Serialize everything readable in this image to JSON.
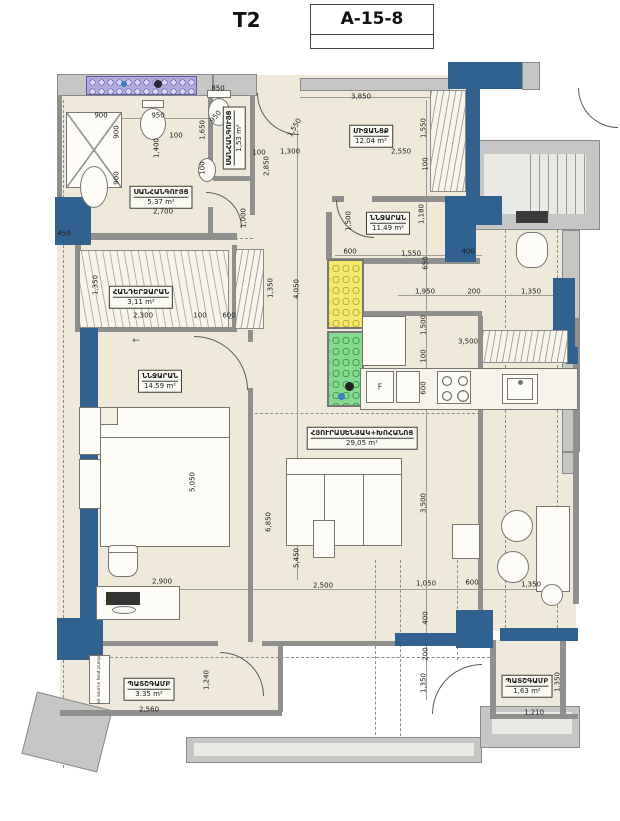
{
  "header": {
    "title": "T2",
    "code": "A-15-8"
  },
  "rooms": [
    {
      "name": "ՍԱՆՀԱՆԳՈՒՅՑ",
      "area": "5.37 m²"
    },
    {
      "name": "ՍԱՆՀԱՆԳՈՒՅՑ",
      "area": "1,53 m²"
    },
    {
      "name": "ՄԻՋԱՆՑՔ",
      "area": "12.04 m²"
    },
    {
      "name": "ՆՆՋԱՐԱՆ",
      "area": "11.49 m²"
    },
    {
      "name": "ՀԱՆԴԵՐՁԱՐԱՆ",
      "area": "3,11 m²"
    },
    {
      "name": "ՆՆՋԱՐԱՆ",
      "area": "14.59 m²"
    },
    {
      "name": "ՀՅՈՒՐԱՍԵՆՅԱԿ+ԽՈՀԱՆՈՑ",
      "area": "29,05 m²"
    },
    {
      "name": "ՊԱՏՇԳԱՄԲ",
      "area": "3.35 m²"
    },
    {
      "name": "ՊԱՏՇԳԱՄԲ",
      "area": "1,63 m²"
    }
  ],
  "annotations": {
    "heat_pump": "air source heat pump",
    "fridge_label": "F",
    "door_arrow": "←"
  },
  "dimensions": [
    {
      "t": "850",
      "x": 218,
      "y": 89
    },
    {
      "t": "900",
      "x": 101,
      "y": 116
    },
    {
      "t": "950",
      "x": 158,
      "y": 116
    },
    {
      "t": "950",
      "x": 216,
      "y": 117,
      "r": -50
    },
    {
      "t": "1,650",
      "x": 203,
      "y": 130,
      "r": -90
    },
    {
      "t": "100",
      "x": 176,
      "y": 136
    },
    {
      "t": "1,400",
      "x": 157,
      "y": 148,
      "r": -90
    },
    {
      "t": "900",
      "x": 117,
      "y": 132,
      "r": -90
    },
    {
      "t": "900",
      "x": 117,
      "y": 178,
      "r": -90
    },
    {
      "t": "100",
      "x": 203,
      "y": 168,
      "r": -90
    },
    {
      "t": "450",
      "x": 64,
      "y": 234
    },
    {
      "t": "1,000",
      "x": 244,
      "y": 218,
      "r": -90
    },
    {
      "t": "2,700",
      "x": 163,
      "y": 212
    },
    {
      "t": "3,850",
      "x": 361,
      "y": 97
    },
    {
      "t": "1,550",
      "x": 295,
      "y": 128,
      "r": -60
    },
    {
      "t": "1,550",
      "x": 424,
      "y": 128,
      "r": -90
    },
    {
      "t": "100",
      "x": 259,
      "y": 153
    },
    {
      "t": "1,300",
      "x": 290,
      "y": 152
    },
    {
      "t": "2,850",
      "x": 267,
      "y": 166,
      "r": -90
    },
    {
      "t": "2,550",
      "x": 401,
      "y": 152
    },
    {
      "t": "100",
      "x": 426,
      "y": 164,
      "r": -90
    },
    {
      "t": "1,180",
      "x": 422,
      "y": 214,
      "r": -90
    },
    {
      "t": "1,500",
      "x": 349,
      "y": 221,
      "r": -90
    },
    {
      "t": "600",
      "x": 350,
      "y": 252
    },
    {
      "t": "1,550",
      "x": 411,
      "y": 254
    },
    {
      "t": "400",
      "x": 468,
      "y": 252
    },
    {
      "t": "650",
      "x": 426,
      "y": 263,
      "r": -90
    },
    {
      "t": "1,950",
      "x": 425,
      "y": 292
    },
    {
      "t": "200",
      "x": 474,
      "y": 292
    },
    {
      "t": "1,350",
      "x": 531,
      "y": 292
    },
    {
      "t": "1,350",
      "x": 96,
      "y": 285,
      "r": -90
    },
    {
      "t": "2,300",
      "x": 143,
      "y": 316
    },
    {
      "t": "100",
      "x": 200,
      "y": 316
    },
    {
      "t": "600",
      "x": 229,
      "y": 316
    },
    {
      "t": "1,350",
      "x": 271,
      "y": 288,
      "r": -90
    },
    {
      "t": "4,050",
      "x": 297,
      "y": 289,
      "r": -90
    },
    {
      "t": "1,500",
      "x": 424,
      "y": 325,
      "r": -90
    },
    {
      "t": "3,500",
      "x": 468,
      "y": 342
    },
    {
      "t": "100",
      "x": 424,
      "y": 356,
      "r": -90
    },
    {
      "t": "600",
      "x": 424,
      "y": 388,
      "r": -90
    },
    {
      "t": "5,050",
      "x": 193,
      "y": 482,
      "r": -90
    },
    {
      "t": "3,500",
      "x": 424,
      "y": 503,
      "r": -90
    },
    {
      "t": "6,850",
      "x": 269,
      "y": 522,
      "r": -90
    },
    {
      "t": "5,450",
      "x": 297,
      "y": 558,
      "r": -90
    },
    {
      "t": "2,900",
      "x": 162,
      "y": 582
    },
    {
      "t": "2,500",
      "x": 323,
      "y": 586
    },
    {
      "t": "1,050",
      "x": 426,
      "y": 584
    },
    {
      "t": "600",
      "x": 472,
      "y": 583
    },
    {
      "t": "1,350",
      "x": 531,
      "y": 585
    },
    {
      "t": "400",
      "x": 426,
      "y": 618,
      "r": -90
    },
    {
      "t": "200",
      "x": 426,
      "y": 654,
      "r": -90
    },
    {
      "t": "1,350",
      "x": 424,
      "y": 683,
      "r": -90
    },
    {
      "t": "1,240",
      "x": 207,
      "y": 680,
      "r": -90
    },
    {
      "t": "2,560",
      "x": 149,
      "y": 710
    },
    {
      "t": "1,210",
      "x": 534,
      "y": 713
    },
    {
      "t": "1,350",
      "x": 558,
      "y": 682,
      "r": -90
    }
  ],
  "colors": {
    "wall_blue": "#31618f",
    "wall_gray": "#9a9a9a",
    "floor_cream": "#efe9d9",
    "shaft_yellow": "#f3e96d",
    "shaft_green": "#86d98e",
    "radiator_purple": "#b0aadd"
  }
}
